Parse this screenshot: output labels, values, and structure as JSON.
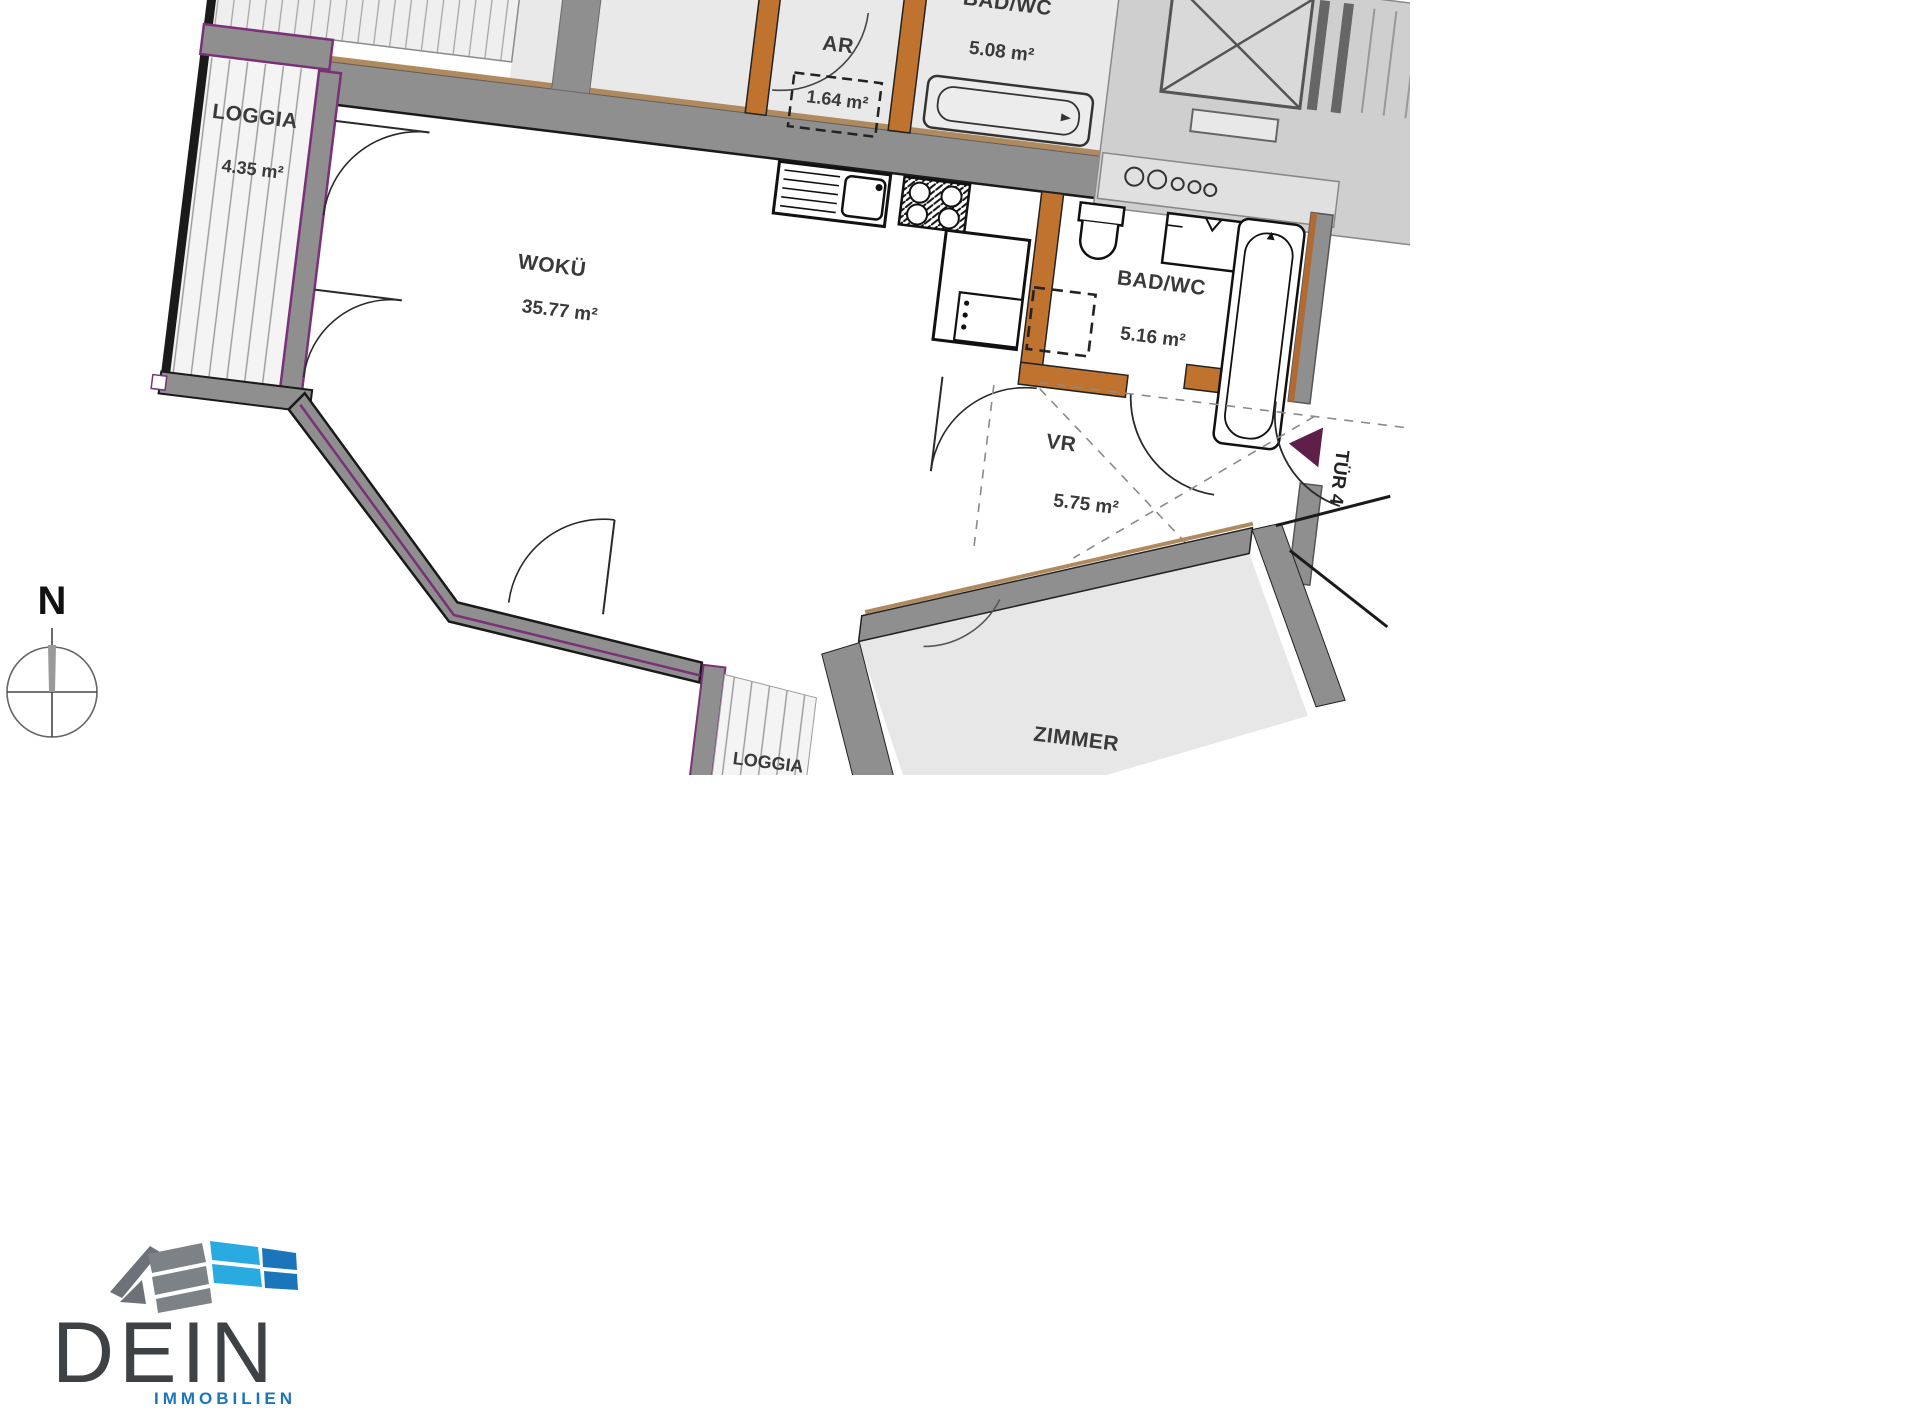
{
  "plan": {
    "compass": "N",
    "entrance_door": "TÜR 4",
    "rooms": {
      "loggia_top": {
        "name": "LOGGIA",
        "area": "4.35 m²"
      },
      "ar": {
        "name": "AR",
        "area": "1.64 m²"
      },
      "bad_wc_top": {
        "name": "BAD/WC",
        "area": "5.08 m²"
      },
      "woku": {
        "name": "WOKÜ",
        "area": "35.77 m²"
      },
      "bad_wc": {
        "name": "BAD/WC",
        "area": "5.16 m²"
      },
      "vr": {
        "name": "VR",
        "area": "5.75 m²"
      },
      "zimmer": {
        "name": "ZIMMER"
      },
      "loggia_bottom": {
        "name": "LOGGIA"
      }
    },
    "colors": {
      "wall_gray": "#8f8f8f",
      "window_purple": "#7a3178",
      "interior_wall_orange": "#c0722f",
      "neighbor_floor": "#e9e9e9",
      "stair_floor": "#cfcfcf",
      "door_marker_maroon": "#5e2048",
      "wall_lining_bronze": "#b08a5f"
    }
  },
  "logo": {
    "brand": "DEIN",
    "subtitle": "IMMOBILIEN",
    "colors": {
      "brand_text": "#3f4245",
      "subtitle_text": "#1b75bb",
      "tile_gray": "#7d8287",
      "tile_blue_light": "#29abe2",
      "tile_blue_dark": "#1b75bb"
    }
  }
}
